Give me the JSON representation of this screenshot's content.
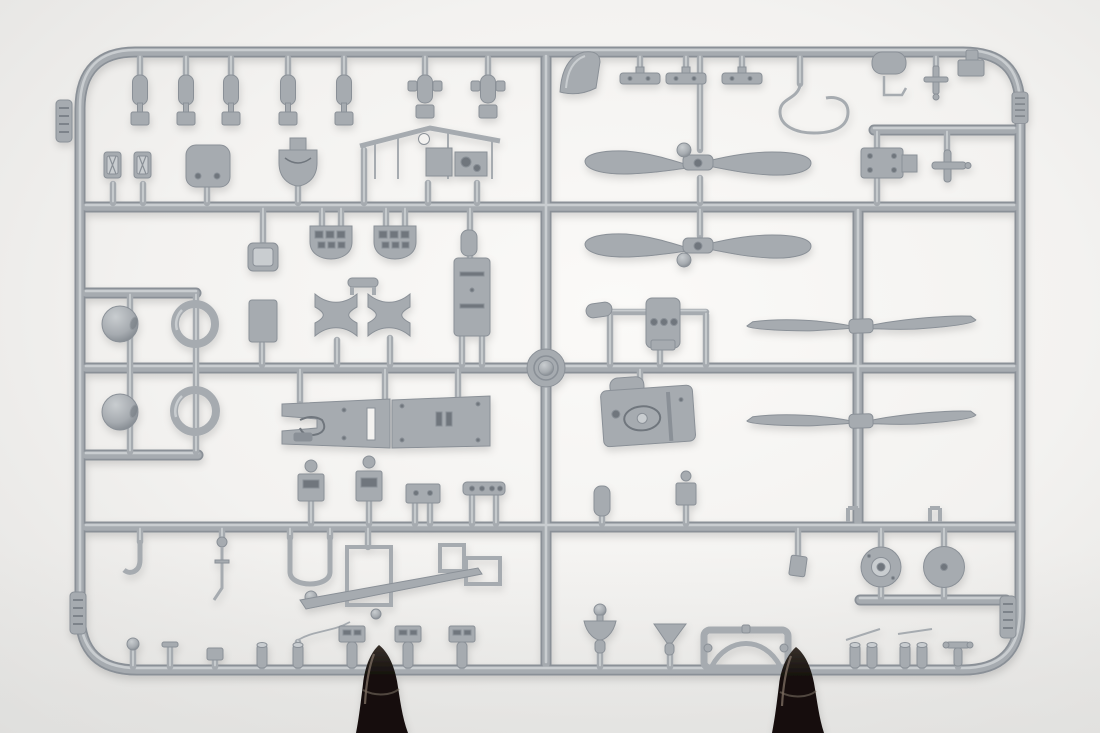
{
  "scene": {
    "type": "photograph",
    "subject": "Gray injection-molded plastic model kit sprue (aircraft parts tree) photographed on a white studio backdrop",
    "support": "Two dark plastic clamps grip the bottom rail of the sprue",
    "visible_text": "none legible"
  },
  "colors": {
    "backdrop_center": "#fbfaf8",
    "backdrop_mid": "#f3f2f0",
    "backdrop_edge": "#e7e6e4",
    "backdrop_low": "#dededc",
    "plastic_light": "#c9cdd0",
    "plastic_mid": "#a6abb0",
    "plastic_dark": "#8a9097",
    "plastic_shadow": "#6f767d",
    "clamp_light": "#7a6c60",
    "clamp_mid": "#37302a",
    "clamp_dark": "#15100d"
  },
  "inventory": {
    "paddle_propellers": 2,
    "slim_propellers": 2,
    "cowling_balls": 2,
    "cowling_rings": 2,
    "wheels": 2,
    "instrument_panels": 2,
    "engine_block": 1,
    "fuselage_decks": 2,
    "windscreen": 1,
    "seats": 2,
    "clamps": 2,
    "small_fittings_top_rail": 12,
    "small_fittings_bottom_rail": 14
  }
}
